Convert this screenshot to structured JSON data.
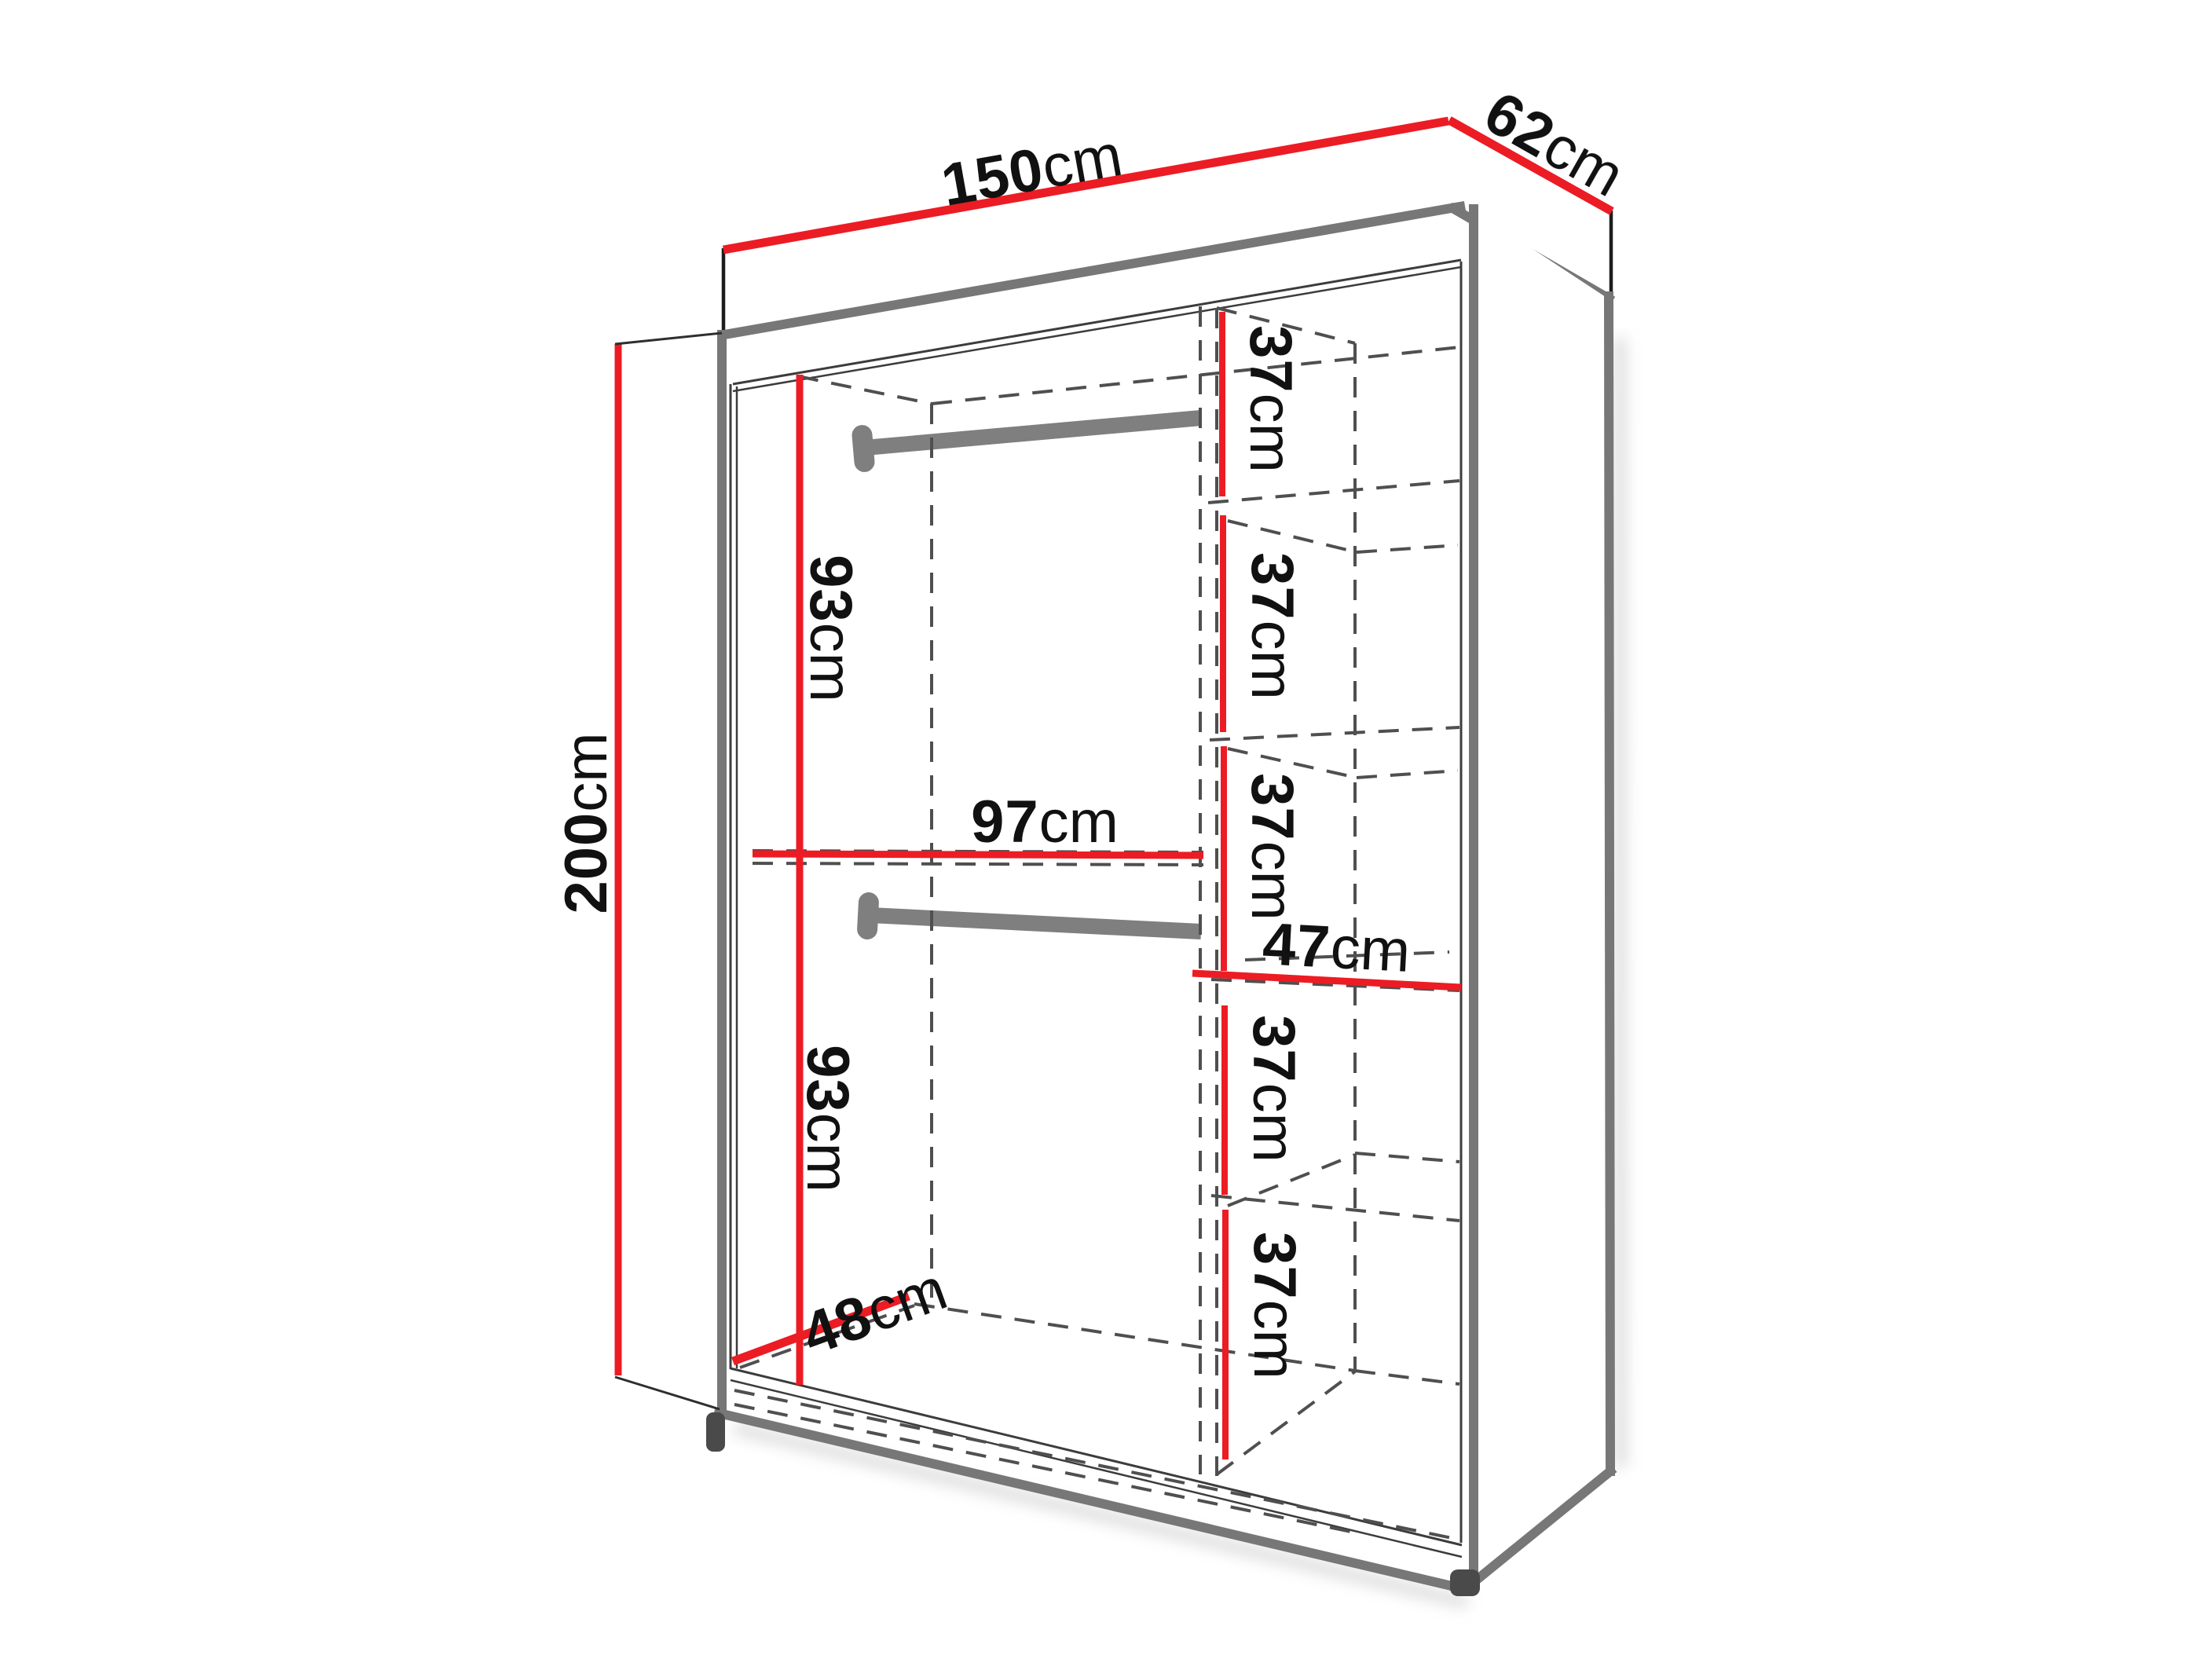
{
  "diagram": {
    "type": "furniture-dimension-diagram",
    "subject": "wardrobe interior dimensions drawing",
    "unit": "cm",
    "colors": {
      "dimension_line": "#EC1C24",
      "structure_edge": "#777777",
      "rail": "#7F7F7F",
      "hidden_edge": "#4F4F4F",
      "label_text": "#111111",
      "background": "#FFFFFF"
    },
    "labels": {
      "width": {
        "value": "150",
        "unit": "cm"
      },
      "depth": {
        "value": "62",
        "unit": "cm"
      },
      "height": {
        "value": "200",
        "unit": "cm"
      },
      "upper_hanging_height": {
        "value": "93",
        "unit": "cm"
      },
      "lower_hanging_height": {
        "value": "93",
        "unit": "cm"
      },
      "interior_width": {
        "value": "97",
        "unit": "cm"
      },
      "shelf_width": {
        "value": "47",
        "unit": "cm"
      },
      "interior_depth_floor": {
        "value": "48",
        "unit": "cm"
      },
      "shelf_heights": [
        {
          "value": "37",
          "unit": "cm"
        },
        {
          "value": "37",
          "unit": "cm"
        },
        {
          "value": "37",
          "unit": "cm"
        },
        {
          "value": "37",
          "unit": "cm"
        },
        {
          "value": "37",
          "unit": "cm"
        }
      ]
    }
  }
}
